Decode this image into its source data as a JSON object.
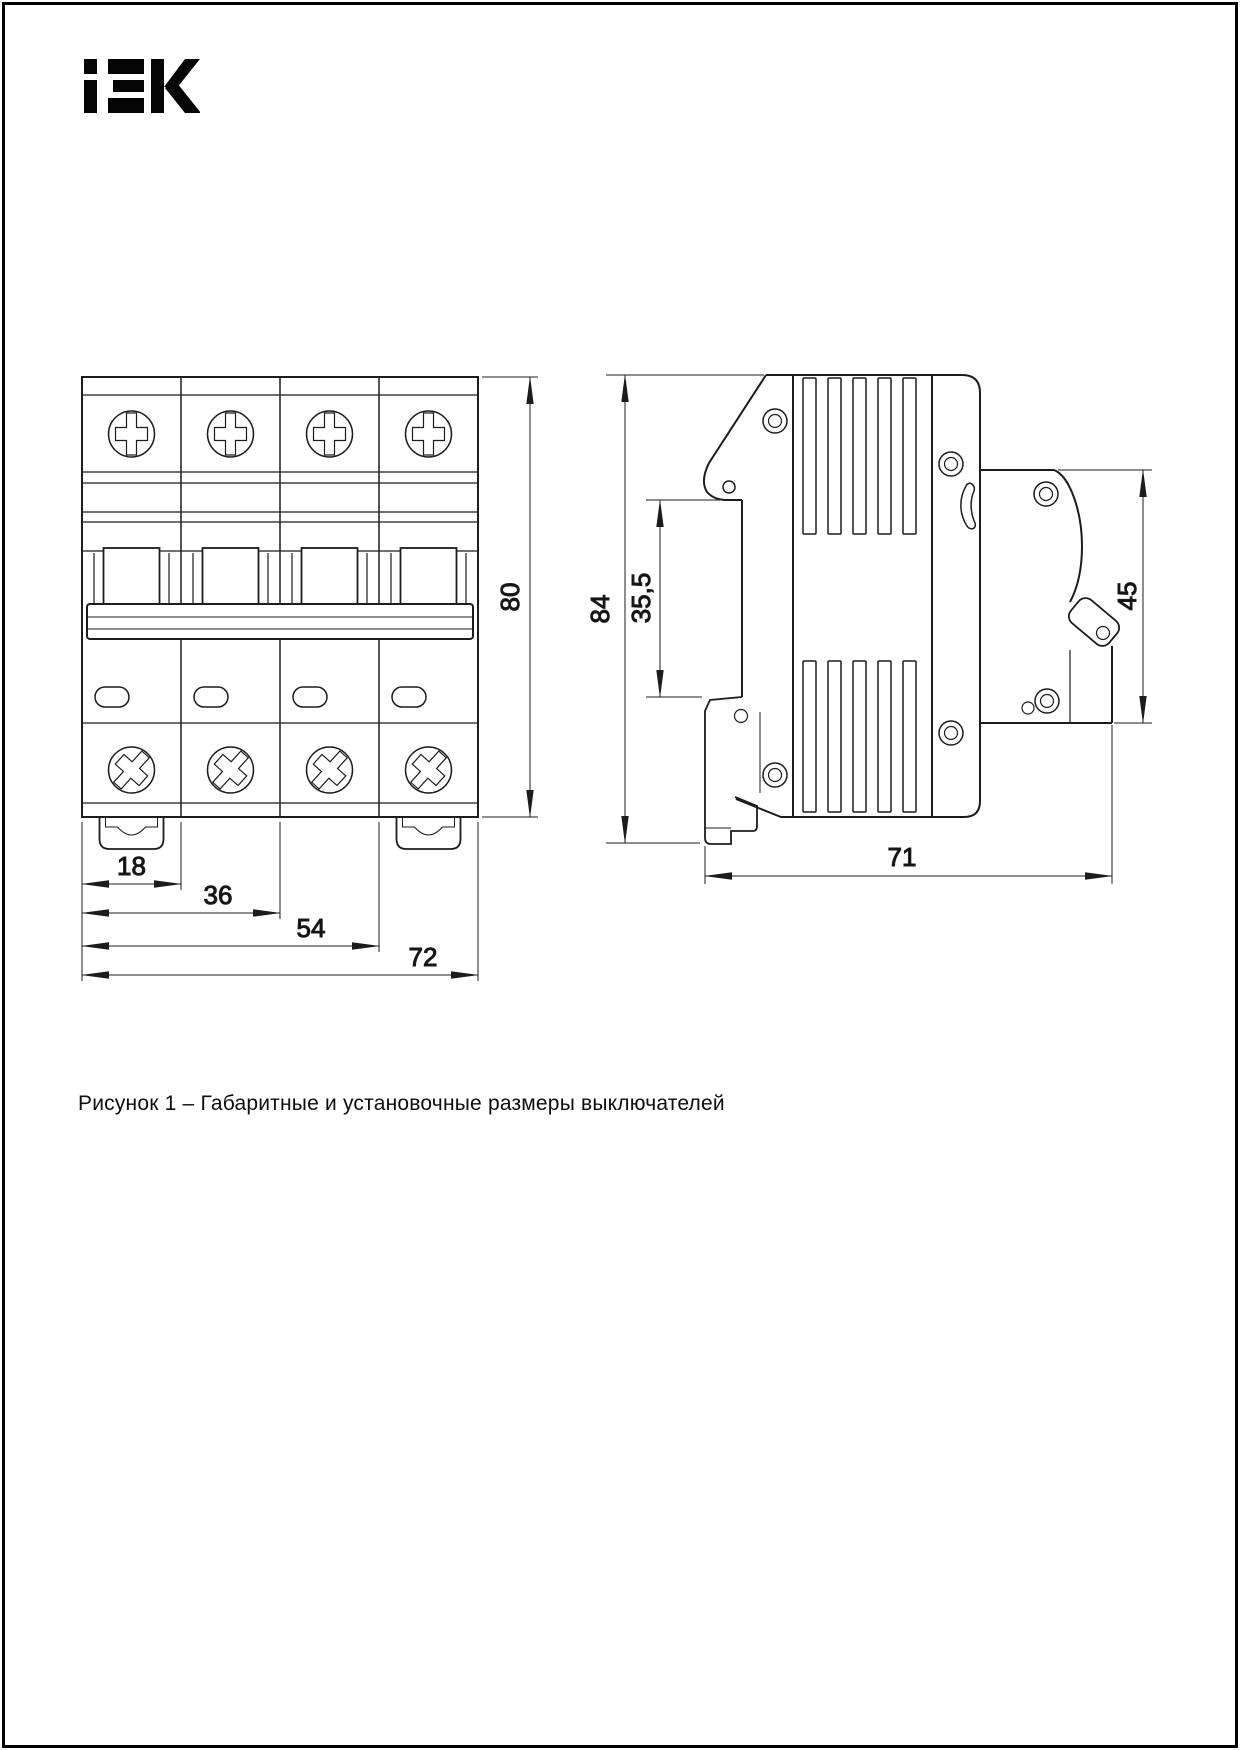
{
  "page": {
    "background": "#ffffff",
    "line_color": "#1c1c1c",
    "border_color": "#000000"
  },
  "logo": {
    "label": "iEK"
  },
  "figure": {
    "front_view": {
      "dims": {
        "module_width": "18",
        "two_modules": "36",
        "three_modules": "54",
        "total_width": "72",
        "height": "80"
      }
    },
    "side_view": {
      "dims": {
        "total_height": "84",
        "rail_recess": "35,5",
        "upper_depth": "45",
        "total_depth": "71"
      }
    }
  },
  "caption": "Рисунок 1 – Габаритные и установочные размеры выключателей"
}
